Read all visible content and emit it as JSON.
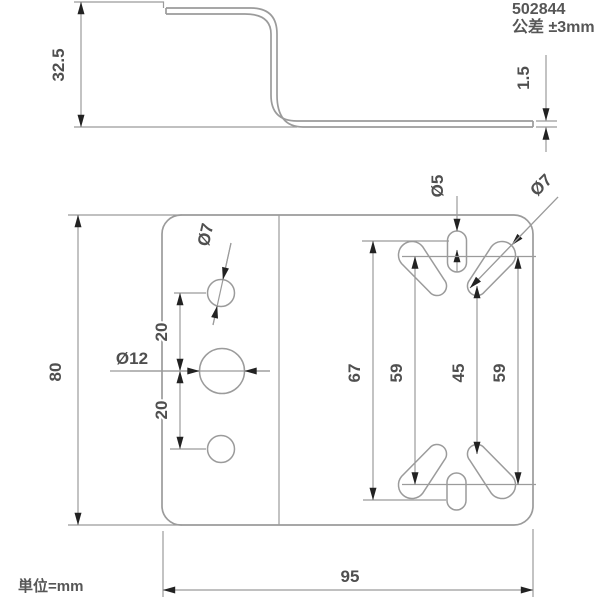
{
  "colors": {
    "background": "#ffffff",
    "line": "#9b9b9b",
    "text": "#4f4f4f",
    "arrow": "#222222"
  },
  "notes": {
    "part_number": "502844",
    "tolerance": "公差 ±3mm",
    "unit": "単位=mm"
  },
  "side_view": {
    "dims": [
      {
        "name": "bracket-height",
        "label": "32.5"
      },
      {
        "name": "plate-thickness",
        "label": "1.5"
      }
    ]
  },
  "plan_view": {
    "dims": [
      {
        "name": "plate-height",
        "label": "80"
      },
      {
        "name": "plate-width",
        "label": "95"
      },
      {
        "name": "hole-spacing-upper",
        "label": "20"
      },
      {
        "name": "hole-spacing-lower",
        "label": "20"
      },
      {
        "name": "slot-outer-span",
        "label": "67"
      },
      {
        "name": "slot-span-left",
        "label": "59"
      },
      {
        "name": "slot-small-span",
        "label": "45"
      },
      {
        "name": "slot-span-right",
        "label": "59"
      }
    ],
    "holes": [
      {
        "name": "upper-round-hole",
        "label": "Ø7"
      },
      {
        "name": "center-round-hole",
        "label": "Ø12"
      },
      {
        "name": "slot-width",
        "label": "Ø5"
      },
      {
        "name": "keyhole-large-end",
        "label": "Ø7"
      }
    ]
  }
}
